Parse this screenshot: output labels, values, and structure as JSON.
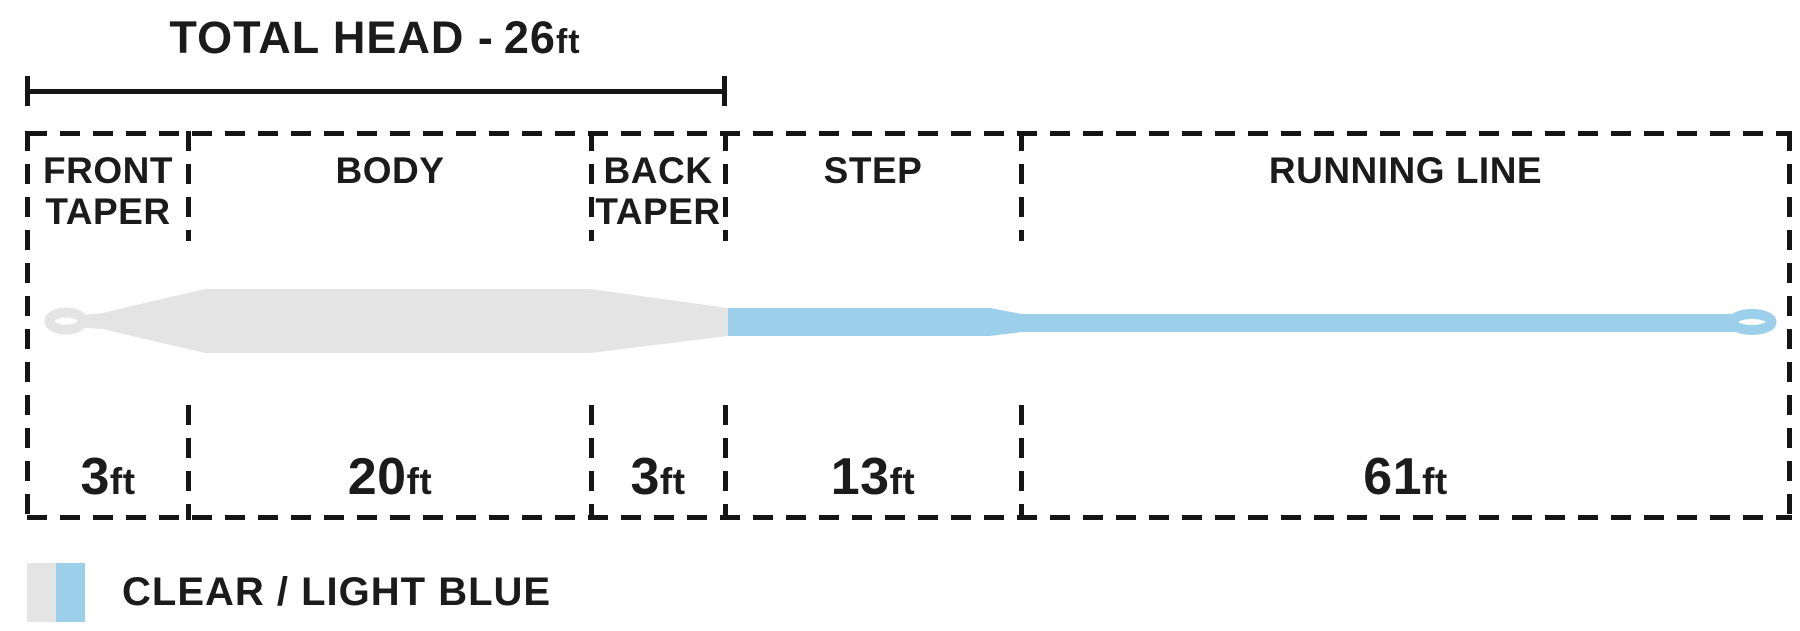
{
  "title": {
    "label": "TOTAL HEAD -",
    "value": "26",
    "unit": "ft"
  },
  "sections": [
    {
      "label": "FRONT TAPER",
      "label_lines": [
        "FRONT",
        "TAPER"
      ],
      "length_value": "3",
      "length_unit": "ft"
    },
    {
      "label": "BODY",
      "label_lines": [
        "BODY"
      ],
      "length_value": "20",
      "length_unit": "ft"
    },
    {
      "label": "BACK TAPER",
      "label_lines": [
        "BACK",
        "TAPER"
      ],
      "length_value": "3",
      "length_unit": "ft"
    },
    {
      "label": "STEP",
      "label_lines": [
        "STEP"
      ],
      "length_value": "13",
      "length_unit": "ft"
    },
    {
      "label": "RUNNING LINE",
      "label_lines": [
        "RUNNING LINE"
      ],
      "length_value": "61",
      "length_unit": "ft"
    }
  ],
  "line": {
    "head_color": "#e4e4e4",
    "rear_color": "#9ccfe9",
    "total_head_ft": 26,
    "section_lengths_ft": [
      3,
      20,
      3,
      13,
      61
    ]
  },
  "legend": {
    "label": "CLEAR / LIGHT BLUE",
    "clear_color": "#e4e4e4",
    "light_blue_color": "#9ccfe9"
  }
}
